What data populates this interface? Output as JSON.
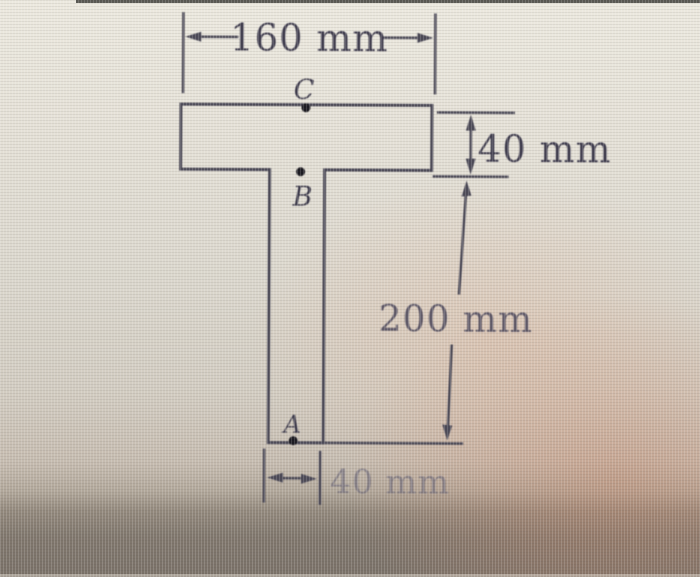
{
  "figure": {
    "points": {
      "c": "C",
      "b": "B",
      "a": "A"
    },
    "dimensions": {
      "flange_width": "160 mm",
      "flange_thickness": "40 mm",
      "web_height": "200 mm",
      "web_width": "40 mm"
    },
    "colors": {
      "section_fill": "#c9cdda",
      "section_outline": "#4c4a58",
      "dimension_line": "#4c4a58",
      "text": "#413e50"
    }
  }
}
